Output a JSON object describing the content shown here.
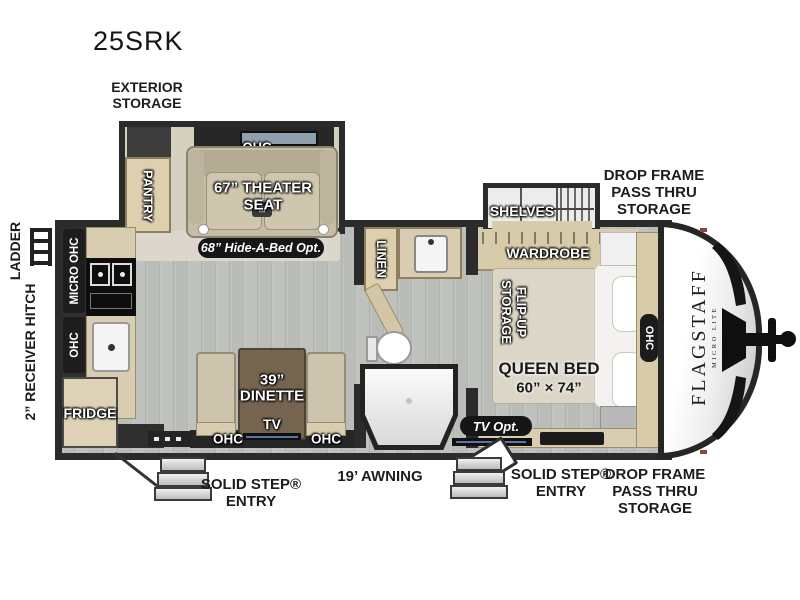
{
  "title": "25SRK",
  "brand": {
    "name": "FLAGSTAFF",
    "tagline": "MICRO LITE"
  },
  "colors": {
    "wall": "#2b2b2b",
    "floor": "#b7b9b4",
    "wood": "#d8cdb0",
    "label_pill": "#161616"
  },
  "exterior": {
    "storage_l1": "EXTERIOR",
    "storage_l2": "STORAGE",
    "ladder": "LADDER",
    "receiver_hitch": "2” RECEIVER HITCH",
    "drop_frame_l1": "DROP FRAME",
    "drop_frame_l2": "PASS THRU",
    "drop_frame_l3": "STORAGE",
    "awning": "19’ AWNING",
    "entry_l1": "SOLID STEP®",
    "entry_l2": "ENTRY"
  },
  "living": {
    "pantry": "PANTRY",
    "ohc_slide": "OHC",
    "theater_l1": "67” THEATER",
    "theater_l2": "SEAT",
    "hide_a_bed": "68” Hide-A-Bed Opt.",
    "dinette_l1": "39”",
    "dinette_l2": "DINETTE",
    "tv": "TV",
    "ohc_left": "OHC",
    "ohc_right": "OHC"
  },
  "kitchen": {
    "micro_ohc": "MICRO OHC",
    "ohc": "OHC",
    "fridge": "FRIDGE"
  },
  "bath": {
    "linen": "LINEN"
  },
  "bedroom": {
    "shelves": "SHELVES",
    "wardrobe": "WARDROBE",
    "flip_up_l1": "FLIP-UP",
    "flip_up_l2": "STORAGE",
    "bed_l1": "QUEEN BED",
    "bed_l2": "60” × 74”",
    "ohc": "OHC",
    "tv_opt": "TV Opt."
  }
}
